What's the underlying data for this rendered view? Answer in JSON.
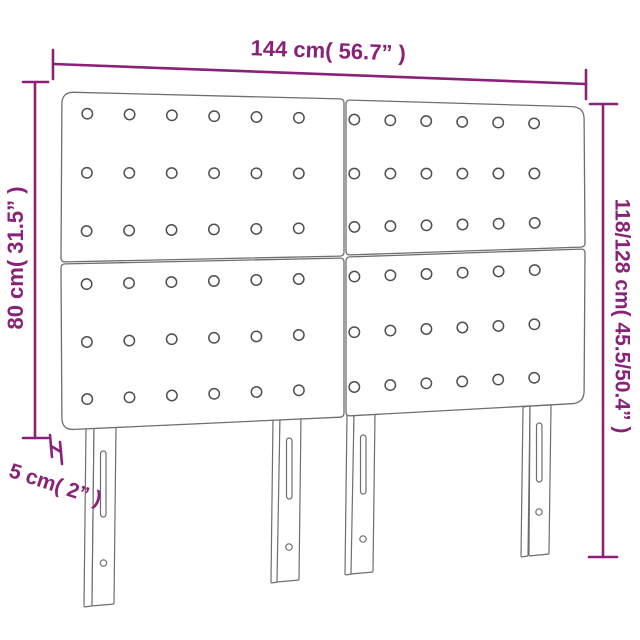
{
  "diagram": {
    "type": "product-dimension-diagram",
    "subject": "tufted-headboard-four-panels-four-legs",
    "colors": {
      "dimension_accent": "#8a2179",
      "outline_gray": "#6e6e6e",
      "button_gray": "#4f4f4f"
    },
    "labels": {
      "top_width": "144 cm( 56.7” )",
      "left_height": "80 cm( 31.5” )",
      "right_height": "118/128 cm( 45.5/50.4” )",
      "depth": "5 cm( 2” )"
    },
    "structure": {
      "panel_rows": 2,
      "panel_cols": 2,
      "button_rows_per_panel": 3,
      "button_cols_per_panel": 6,
      "leg_count": 4
    }
  }
}
